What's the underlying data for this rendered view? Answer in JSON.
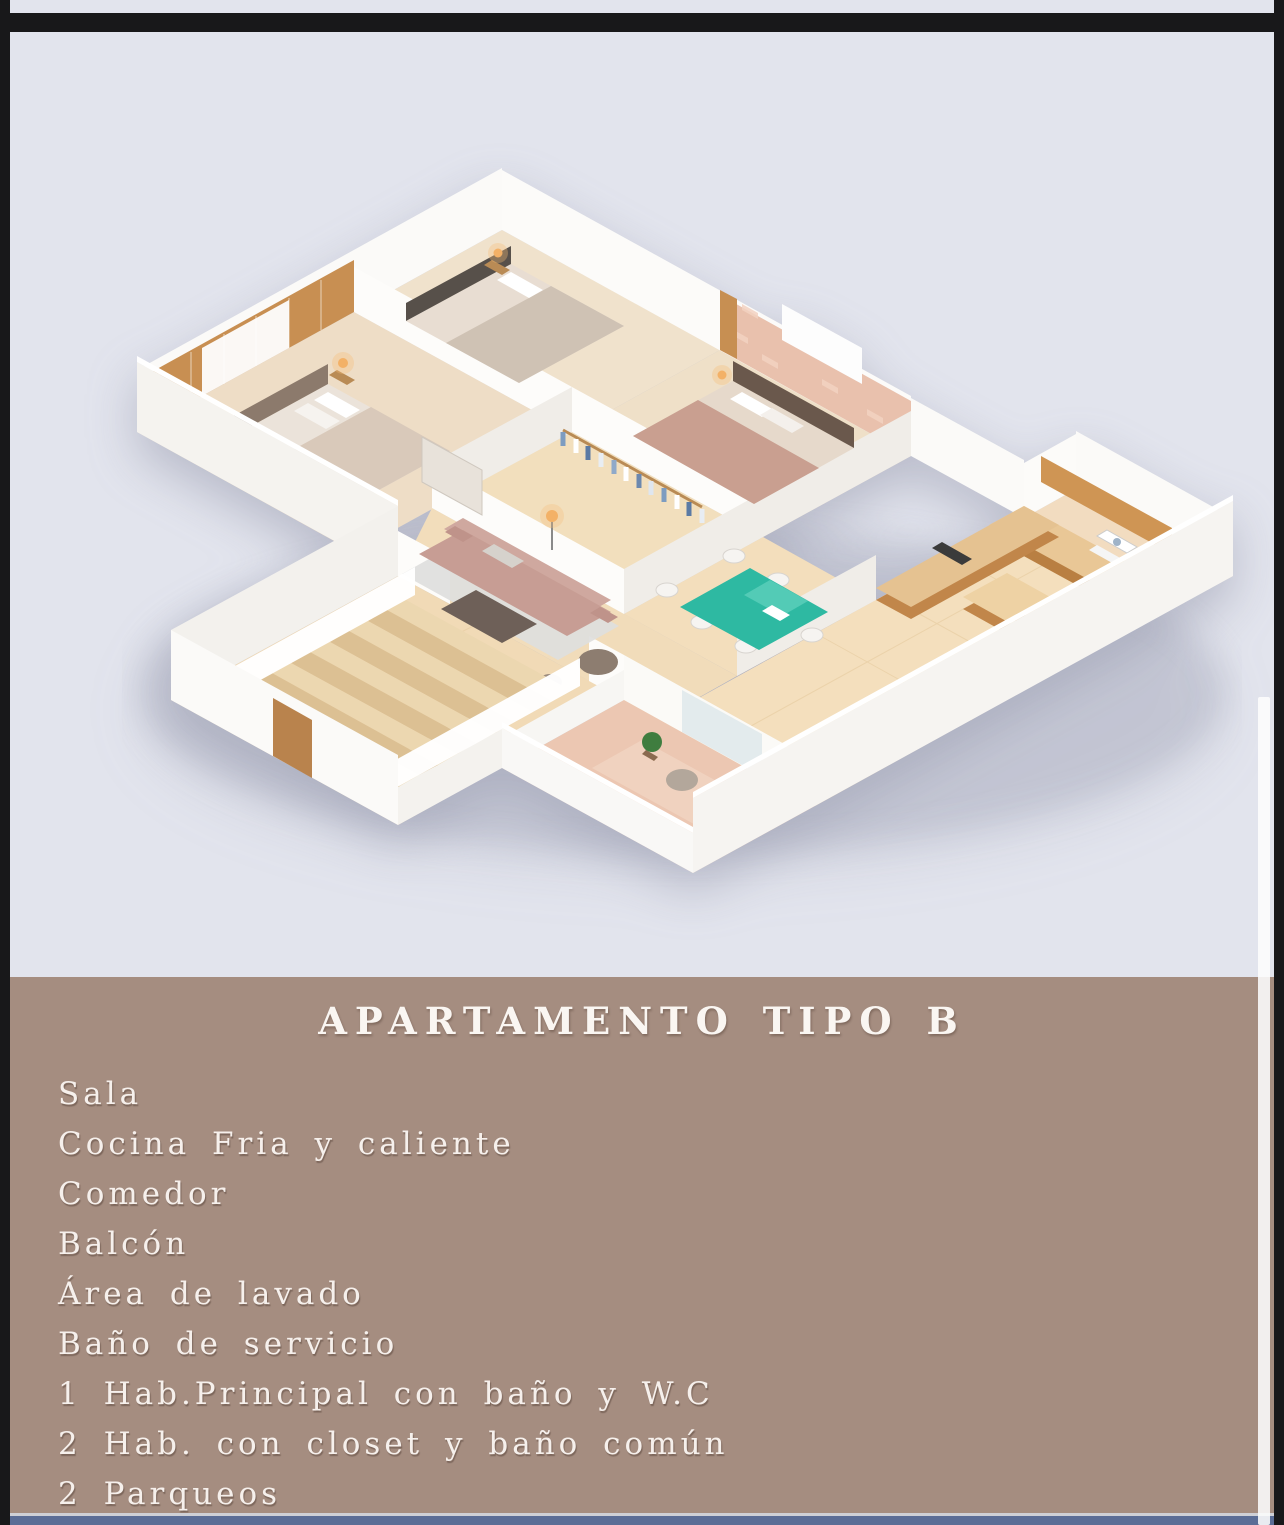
{
  "frame": {
    "border_color": "#18181a",
    "top_strip_color": "#e2e4ed",
    "divider_color": "#cfd0d6",
    "bottom_bar_color": "#5b6d96"
  },
  "hero": {
    "background": "#e2e4ed",
    "description": "3D isometric render of apartment floor plan"
  },
  "floor_plan_colors": {
    "walls": "#fbfaf8",
    "floor_tile": "#f2deba",
    "accent_brick": "#e9c1ad",
    "accent_wood": "#c88f52",
    "kitchen_cabinets": "#c1864a",
    "dining_table": "#2eb9a2",
    "sofa": "#c79d94",
    "balcony_floor": "#ecc7b2"
  },
  "info_panel": {
    "background": "#a58d80",
    "text_color": "#f7f2ee",
    "title": "APARTAMENTO TIPO B",
    "features": [
      "Sala",
      "Cocina Fria y caliente",
      "Comedor",
      "Balcón",
      "Área de lavado",
      "Baño de servicio",
      "1 Hab.Principal con baño y W.C",
      "2 Hab. con closet y baño común",
      "2 Parqueos"
    ]
  }
}
